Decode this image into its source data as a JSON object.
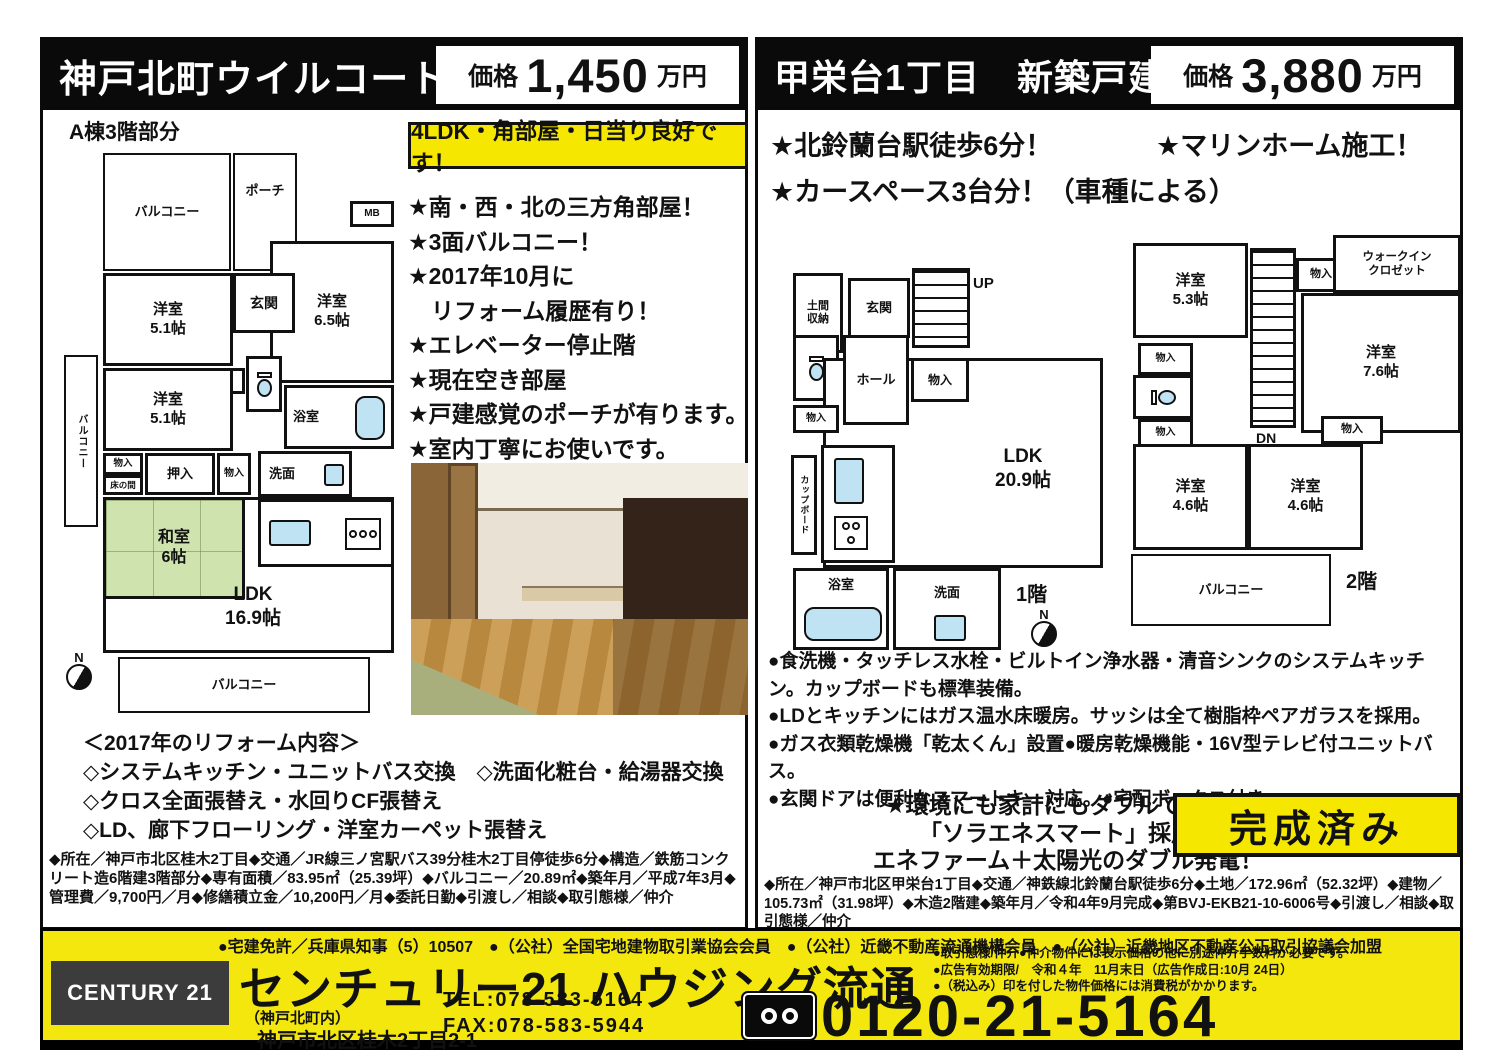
{
  "left": {
    "title": "神戸北町ウイルコート",
    "price_label": "価格",
    "price_value": "1,450",
    "price_unit": "万円",
    "plan_caption": "A棟3階部分",
    "highlight": "4LDK・角部屋・日当り良好です！",
    "bullets": [
      "★南・西・北の三方角部屋！",
      "★3面バルコニー！",
      "★2017年10月に",
      "　リフォーム履歴有り！",
      "★エレベーター停止階",
      "★現在空き部屋",
      "★戸建感覚のポーチが有ります。",
      "★室内丁寧にお使いです。"
    ],
    "plan": {
      "balcony_top": "バルコニー",
      "porch": "ポーチ",
      "mb": "MB",
      "genkan": "玄関",
      "room1_name": "洋室",
      "room1_size": "5.1帖",
      "room2_name": "洋室",
      "room2_size": "6.5帖",
      "room3_name": "洋室",
      "room3_size": "5.1帖",
      "closet_a": "物入",
      "balcony_left": "バルコニー",
      "closet_b": "物入",
      "tokonoma": "床の間",
      "oshiire": "押入",
      "closet_c": "物入",
      "washitsu_name": "和室",
      "washitsu_size": "6帖",
      "bath": "浴室",
      "senmen": "洗面",
      "ldk_name": "LDK",
      "ldk_size": "16.9帖",
      "balcony_bottom": "バルコニー",
      "compass": "N"
    },
    "reform_title": "＜2017年のリフォーム内容＞",
    "reform_lines": [
      "◇システムキッチン・ユニットバス交換　◇洗面化粧台・給湯器交換",
      "◇クロス全面張替え・水回りCF張替え",
      "◇LD、廊下フローリング・洋室カーペット張替え"
    ],
    "details": "◆所在／神戸市北区桂木2丁目◆交通／JR線三ノ宮駅バス39分桂木2丁目停徒歩6分◆構造／鉄筋コンクリート造6階建3階部分◆専有面積／83.95㎡（25.39坪）◆バルコニー／20.89㎡◆築年月／平成7年3月◆管理費／9,700円／月◆修繕積立金／10,200円／月◆委託日勤◆引渡し／相談◆取引態様／仲介"
  },
  "right": {
    "title": "甲栄台1丁目　新築戸建",
    "price_label": "価格",
    "price_value": "3,880",
    "price_unit": "万円",
    "bullet1": "★北鈴蘭台駅徒歩6分！",
    "bullet2": "★マリンホーム施工！",
    "bullet3": "★カースペース3台分！（車種による）",
    "plan1": {
      "doma": "土間収納",
      "genkan": "玄関",
      "up": "UP",
      "hall": "ホール",
      "closet1": "物入",
      "closet2": "物入",
      "cupboard": "カップボード",
      "ldk_name": "LDK",
      "ldk_size": "20.9帖",
      "bath": "浴室",
      "senmen": "洗面",
      "floor": "1階",
      "compass": "N"
    },
    "plan2": {
      "room1_name": "洋室",
      "room1_size": "5.3帖",
      "wic1": "ウォークイン",
      "wic2": "クロゼット",
      "closet_top": "物入",
      "dn": "DN",
      "room2_name": "洋室",
      "room2_size": "7.6帖",
      "closet_l1": "物入",
      "closet_l2": "物入",
      "closet_r": "物入",
      "room3_name": "洋室",
      "room3_size": "4.6帖",
      "room4_name": "洋室",
      "room4_size": "4.6帖",
      "balcony": "バルコニー",
      "floor": "2階"
    },
    "features": [
      "●食洗機・タッチレス水栓・ビルトイン浄水器・清音シンクのシステムキッチン。カップボードも標準装備。",
      "●LDとキッチンにはガス温水床暖房。サッシは全て樹脂枠ペアガラスを採用。",
      "●ガス衣類乾燥機「乾太くん」設置●暖房乾燥機能・16V型テレビ付ユニットバス。",
      "●玄関ドアは便利なスマートキー対応。●宅配ボックス付き"
    ],
    "eco_lines": [
      "★環境にも家計にもダブルで優しい",
      "「ソラエネスマート」採用！",
      "エネファーム＋太陽光のダブル発電！"
    ],
    "badge": "完成済み",
    "details": "◆所在／神戸市北区甲栄台1丁目◆交通／神鉄線北鈴蘭台駅徒歩6分◆土地／172.96㎡（52.32坪）◆建物／105.73㎡（31.98坪）◆木造2階建◆築年月／令和4年9月完成◆第BVJ-EKB21-10-6006号◆引渡し／相談◆取引態様／仲介"
  },
  "footer": {
    "license": "●宅建免許／兵庫県知事（5）10507　●（公社）全国宅地建物取引業協会会員　●（公社）近畿不動産流通機構会員　●（公社）近畿地区不動産公正取引協議会加盟",
    "brand": "CENTURY 21",
    "company": "センチュリー21 ハウジング流通",
    "branch": "（神戸北町内）",
    "address": "神戸市北区桂木2丁目2-1",
    "tel": "TEL:078-583-5164",
    "fax": "FAX:078-583-5944",
    "notes": [
      "●取引態様/仲介●仲介物件には表示価格の他に別途仲介手数料が必要です。",
      "●広告有効期限/　令和４年　11月末日（広告作成日:10月 24日）",
      "●（税込み）印を付した物件価格には消費税がかかります。"
    ],
    "freedial": "0120-21-5164"
  },
  "colors": {
    "yellow": "#f3e70e",
    "tatami": "#cfe3ae",
    "fixture_blue": "#bfe3f2"
  }
}
